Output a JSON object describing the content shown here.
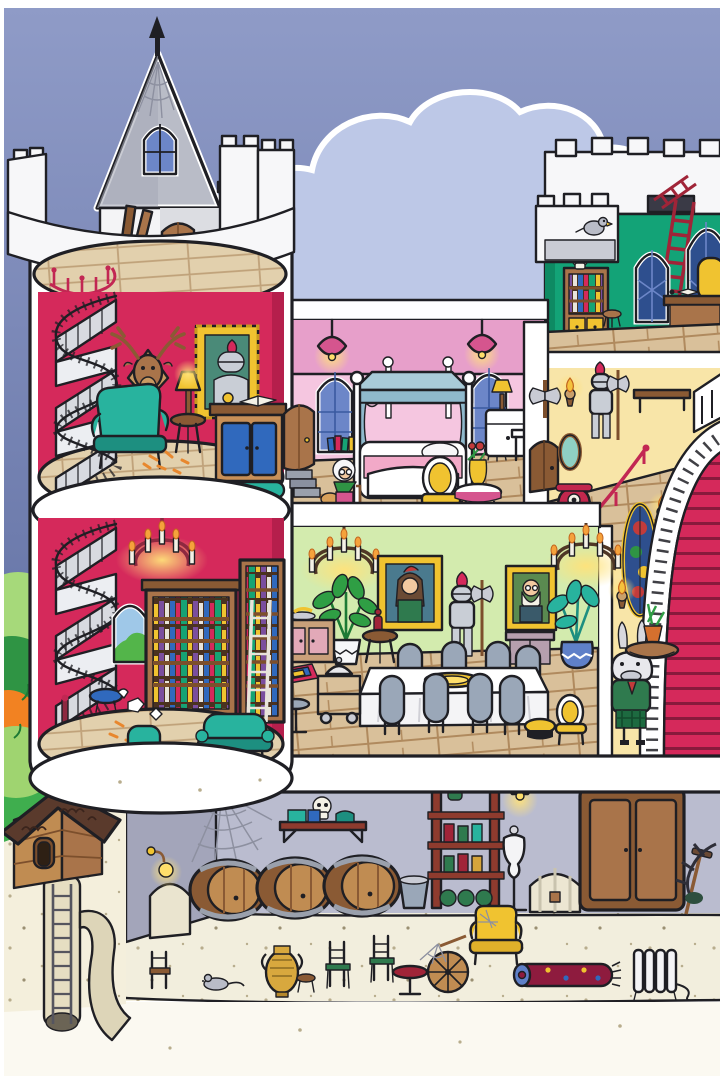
{
  "page": {
    "type": "illustration",
    "subject": "cutaway castle dollhouse scene, seek-and-find cartoon style, no text"
  },
  "colors": {
    "sky_top": "#8f9bc7",
    "sky_bottom": "#5f6ea1",
    "cloud": "#bdc8e7",
    "cloud_outline": "#ffffff",
    "tower_red": "#d5295b",
    "tower_red_shade": "#b51f4c",
    "pink_dark": "#e79fca",
    "pink_light": "#f5c6e0",
    "attic_green": "#13a377",
    "dining_green": "#d3ebae",
    "hall_yellow": "#f8e5a8",
    "cellar_wall": "#babccf",
    "stone_gray": "#a3a5ba",
    "sand": "#f2eedd",
    "grass": "#3fae4e",
    "bush_light": "#a6d97a",
    "bush_dark": "#2f9444",
    "bush_orange": "#f28222",
    "carpet_red": "#d5295b",
    "wood_mid": "#a9744a",
    "wood_dark": "#7c4f2c",
    "wood_light": "#c89058",
    "floor_wood": "#d9c09a",
    "floor_tan": "#e4d3b3",
    "furniture_teal": "#28b39e",
    "accent_gold": "#f0c330",
    "accent_blue": "#3069bd",
    "window_blue": "#6c86c8",
    "window_navy": "#2e4f8e",
    "roof_gray": "#b9bcc7",
    "chair_gray": "#9aa7b8",
    "glow_yellow": "#ffe27a"
  },
  "scene": {
    "rooms": [
      {
        "name": "turret-rooftop",
        "items": [
          "conical-gray-roof",
          "spider-web",
          "dormer-window",
          "wooden-door",
          "leaning-planks",
          "ladder",
          "wooden-platform",
          "red-spiral-railing",
          "crenellated-parapet"
        ]
      },
      {
        "name": "tower-study",
        "wall": "crimson",
        "items": [
          "spiral-staircase",
          "deer-head-trophy",
          "knight-portrait-gold-frame",
          "teal-armchair",
          "side-table-with-lamp",
          "writing-desk-blue-doors",
          "open-book",
          "brass-bell",
          "teal-footstool",
          "fallen-leaves"
        ]
      },
      {
        "name": "tower-library",
        "wall": "crimson",
        "items": [
          "candle-chandelier",
          "spiral-staircase",
          "arched-window",
          "large-bookshelf",
          "tall-bookshelf-with-ladder",
          "blue-stool",
          "paper-doodles",
          "teal-chair-with-book",
          "yellow-stool",
          "teal-settee"
        ]
      },
      {
        "name": "pink-bedroom",
        "wall": "pink",
        "items": [
          "two-hanging-lamps",
          "two-gothic-windows",
          "four-poster-bed",
          "stacked-books",
          "nightstand-with-lamp",
          "console-table",
          "green-stool",
          "yellow-chair",
          "round-table-with-flower-vase",
          "door-to-tower",
          "steps"
        ]
      },
      {
        "name": "green-attic",
        "wall": "emerald",
        "items": [
          "crenellated-roof",
          "roof-hatch",
          "red-ladder",
          "skull-on-bookcase",
          "stool",
          "two-gothic-windows",
          "desk-with-book",
          "yellow-chair",
          "pigeon"
        ]
      },
      {
        "name": "yellow-landing",
        "wall": "pale-yellow",
        "items": [
          "double-axe-plaque",
          "lit-torch",
          "knight-armor-red-plume",
          "wooden-bench",
          "arched-door",
          "oval-mirror",
          "red-telephone-on-stool",
          "red-handrail"
        ]
      },
      {
        "name": "dining-hall",
        "wall": "light-green",
        "items": [
          "two-chandeliers",
          "lady-portrait",
          "old-man-portrait",
          "knight-armor-with-axe",
          "potted-plant-green",
          "potted-plant-teal",
          "sideboard-with-fruit",
          "small-table-with-carafe",
          "sideboard-mauve",
          "long-white-table",
          "gold-platter",
          "eight-gray-chairs",
          "serving-cart-with-cloche",
          "small-rug",
          "gray-stool",
          "yellow-stool",
          "yellow-chair"
        ]
      },
      {
        "name": "grand-staircase",
        "items": [
          "red-carpet-steps",
          "white-balustrade",
          "oval-stained-glass-window",
          "two-torch-sconces",
          "goat-butler-balancing-table",
          "potted-plant"
        ]
      },
      {
        "name": "cellar",
        "wall": "lavender-gray",
        "items": [
          "spider-web",
          "wall-shelf-with-skull",
          "wall-lamp",
          "stone-wall-arch",
          "three-barrels",
          "bucket",
          "wine-rack-with-bottles",
          "hanging-lamp",
          "dress-mannequin",
          "striped-chest",
          "wardrobe",
          "rake",
          "dead-branch",
          "small-chair",
          "mouse",
          "amphora",
          "stool",
          "two-chairs",
          "round-table",
          "spinning-wheel-with-web",
          "yellow-wingback-armchair",
          "rolled-rug",
          "radiator-with-cord"
        ]
      },
      {
        "name": "garden",
        "items": [
          "bushes",
          "grass",
          "sand-path",
          "birdhouse-hut",
          "underground-ladder-shaft",
          "winding-tunnel"
        ]
      }
    ],
    "characters": [
      "granny-with-cane-and-cat",
      "goat-butler",
      "pigeon",
      "mouse"
    ]
  }
}
